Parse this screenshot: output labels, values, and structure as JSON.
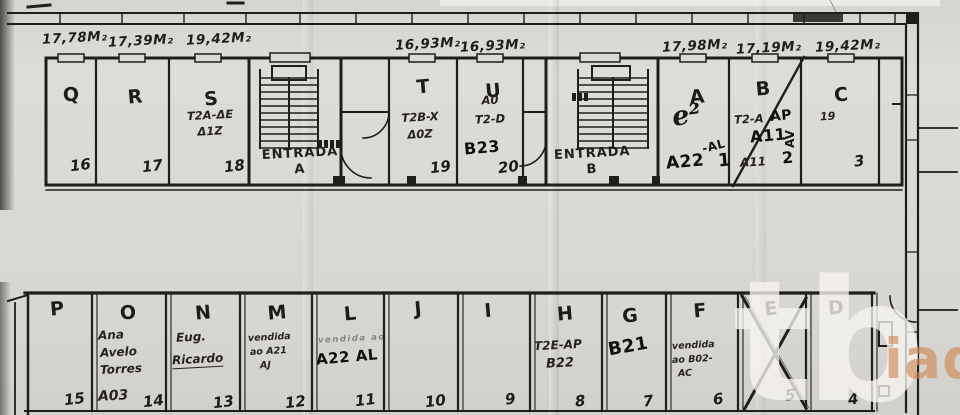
{
  "watermark": {
    "shapes": "tb",
    "brand": "iad"
  },
  "areas_m2": {
    "q": "17,78M₂",
    "r": "17,39M₂",
    "s": "19,42M₂",
    "t": "16,93M₂",
    "u": "16,93M₂",
    "a": "17,98M₂",
    "b": "17,19M₂",
    "c": "19,42M₂"
  },
  "entrance_a": {
    "line1": "ENTRADA",
    "line2": "A"
  },
  "entrance_b": {
    "line1": "ENTRADA",
    "line2": "B"
  },
  "rooms_top": {
    "q": {
      "letter": "Q",
      "number": "16"
    },
    "r": {
      "letter": "R",
      "number": "17"
    },
    "s": {
      "letter": "S",
      "number": "18",
      "note1": "T2A-ΔE",
      "note2": "Δ1Z"
    },
    "t": {
      "letter": "T",
      "number": "19",
      "note1": "T2B-X",
      "note2": "Δ0Z"
    },
    "u": {
      "letter": "U",
      "number": "20",
      "note1": "A0",
      "note2": "T2-D",
      "marker": "B23"
    },
    "a": {
      "letter": "A",
      "number": "1",
      "script": "e²",
      "marker": "A22",
      "sup": "-AL"
    },
    "b": {
      "letter": "B",
      "number": "2",
      "note1": "T2-A",
      "marker1": "AP",
      "marker2": "A11",
      "note2": "A11",
      "side": "AV"
    },
    "c": {
      "letter": "C",
      "number": "3",
      "small": "19"
    }
  },
  "rooms_bottom": {
    "p": {
      "letter": "P",
      "number": "15"
    },
    "o": {
      "letter": "O",
      "number": "14",
      "line1": "Ana",
      "line2": "Avelo",
      "line3": "Torres",
      "line4": "A03"
    },
    "n": {
      "letter": "N",
      "number": "13",
      "line1": "Eug.",
      "line2": "Ricardo"
    },
    "m": {
      "letter": "M",
      "number": "12",
      "line1": "vendida",
      "line2": "ao A21",
      "line3": "AJ"
    },
    "l": {
      "letter": "L",
      "number": "11",
      "faint": "vendida ao",
      "marker": "A22 AL"
    },
    "j": {
      "letter": "J",
      "number": "10"
    },
    "i": {
      "letter": "I",
      "number": "9"
    },
    "h": {
      "letter": "H",
      "number": "8",
      "line1": "T2E-AP",
      "line2": "B22"
    },
    "g": {
      "letter": "G",
      "number": "7",
      "marker": "B21"
    },
    "f": {
      "letter": "F",
      "number": "6",
      "line1": "vendida",
      "line2": "ao B02-",
      "line3": "AC"
    },
    "e": {
      "letter": "E",
      "number": "5"
    },
    "d": {
      "letter": "D",
      "number": "4"
    }
  }
}
